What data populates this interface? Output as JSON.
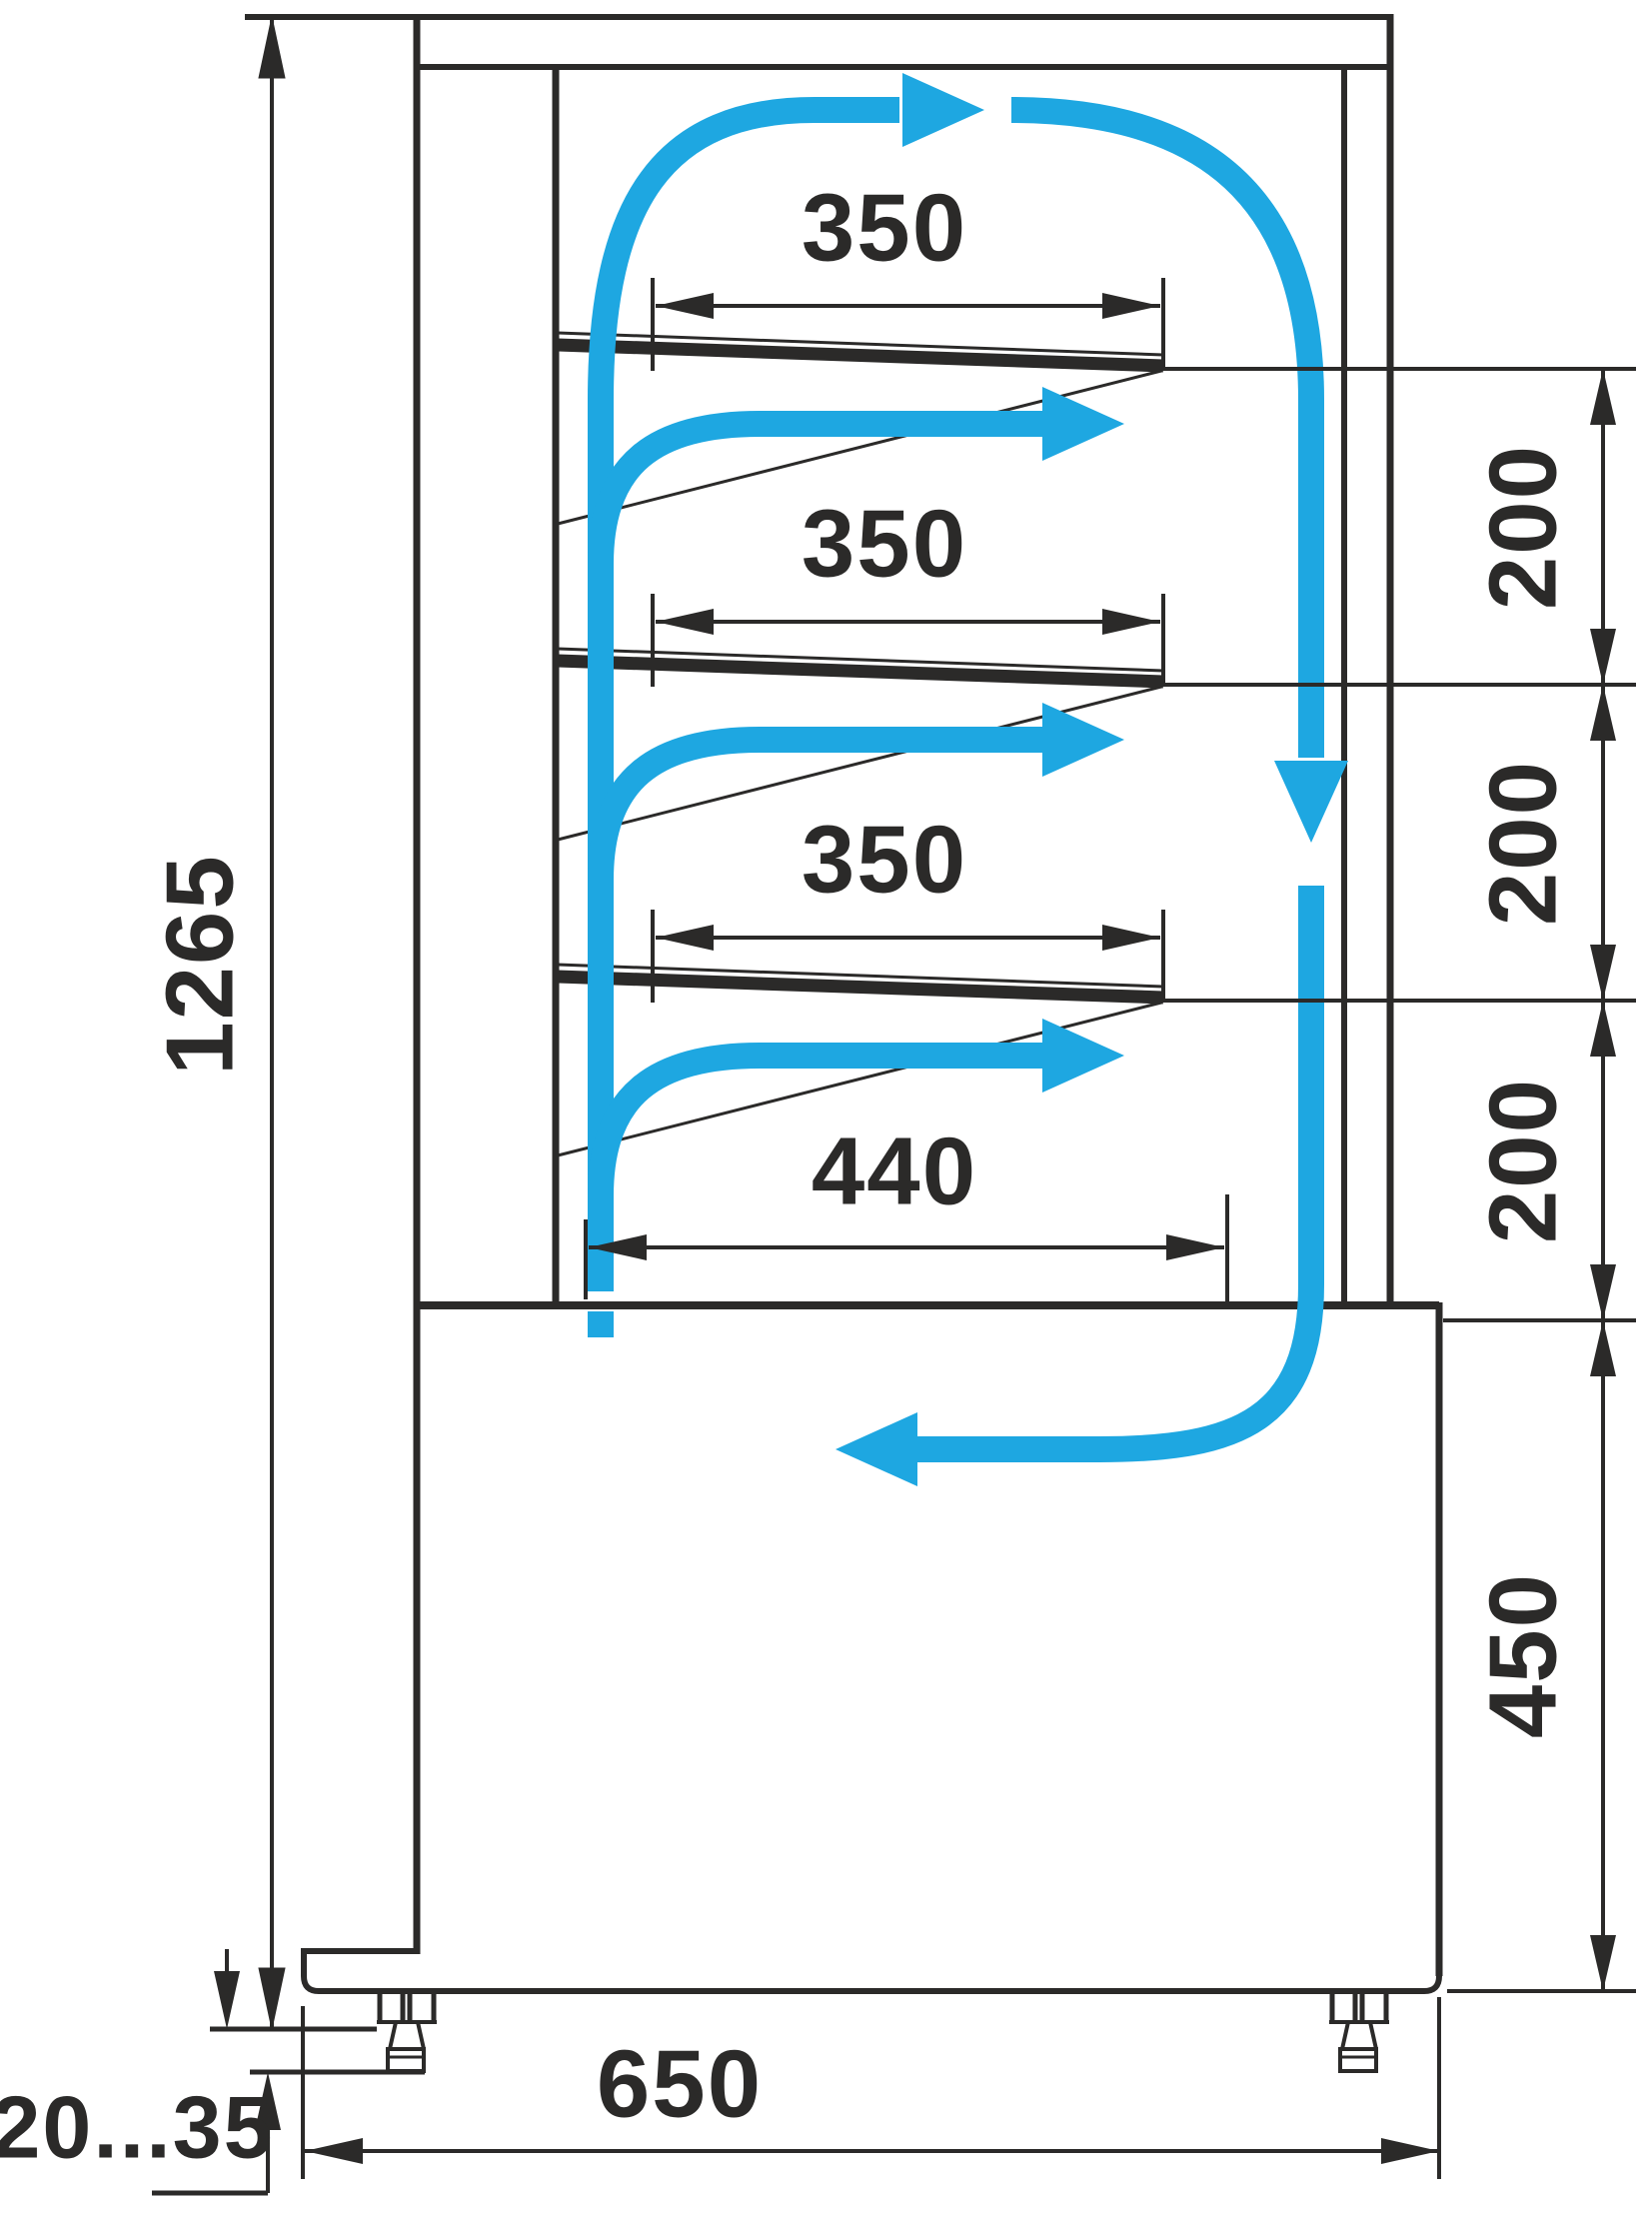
{
  "diagram": {
    "kind": "technical-drawing",
    "colors": {
      "line_color": "#2b2a29",
      "airflow_color": "#1ea7e1",
      "background": "#ffffff"
    },
    "dimension_labels": {
      "total_height": "1265",
      "shelf_depth_1": "350",
      "shelf_depth_2": "350",
      "shelf_depth_3": "350",
      "bottom_shelf_depth": "440",
      "shelf_gap_1": "200",
      "shelf_gap_2": "200",
      "shelf_gap_3": "200",
      "base_height": "450",
      "overall_depth": "650",
      "leg_adjustment_range": "20...35"
    }
  }
}
